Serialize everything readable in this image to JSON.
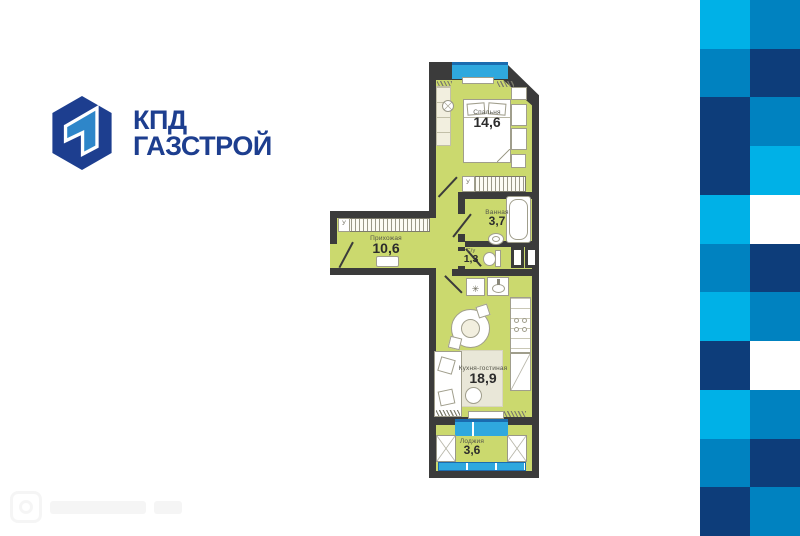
{
  "brand": {
    "name_line1": "КПД",
    "name_line2": "ГАЗСТРОЙ",
    "logo_navy": "#1d3e8f",
    "logo_blue": "#2e86c9"
  },
  "floorplan": {
    "wall_color": "#3b3b3b",
    "floor_color": "#cbd96e",
    "window_color": "#2fa8de",
    "window_frame_color": "#1a6cb0",
    "wardrobe_mark": "У",
    "rooms": [
      {
        "id": "bedroom",
        "name": "Спальня",
        "area": "14,6"
      },
      {
        "id": "bathroom",
        "name": "Ванная",
        "area": "3,7"
      },
      {
        "id": "wc",
        "name": "С/у",
        "area": "1,3"
      },
      {
        "id": "hallway",
        "name": "Прихожая",
        "area": "10,6"
      },
      {
        "id": "kitchen-living",
        "name": "Кухня-гостиная",
        "area": "18,9"
      },
      {
        "id": "loggia",
        "name": "Лоджия",
        "area": "3,6"
      }
    ]
  },
  "pattern": {
    "columns": 2,
    "rows": [
      [
        "light",
        "mid"
      ],
      [
        "mid",
        "navy"
      ],
      [
        "navy",
        "mid"
      ],
      [
        "navy",
        "light"
      ],
      [
        "light",
        "white"
      ],
      [
        "mid",
        "navy"
      ],
      [
        "light",
        "mid"
      ],
      [
        "navy",
        "white"
      ],
      [
        "light",
        "mid"
      ],
      [
        "mid",
        "navy"
      ],
      [
        "navy",
        "mid"
      ]
    ],
    "colors": {
      "light": "#00b1e7",
      "mid": "#0082c0",
      "navy": "#0d3d7a",
      "white": "#ffffff"
    }
  }
}
